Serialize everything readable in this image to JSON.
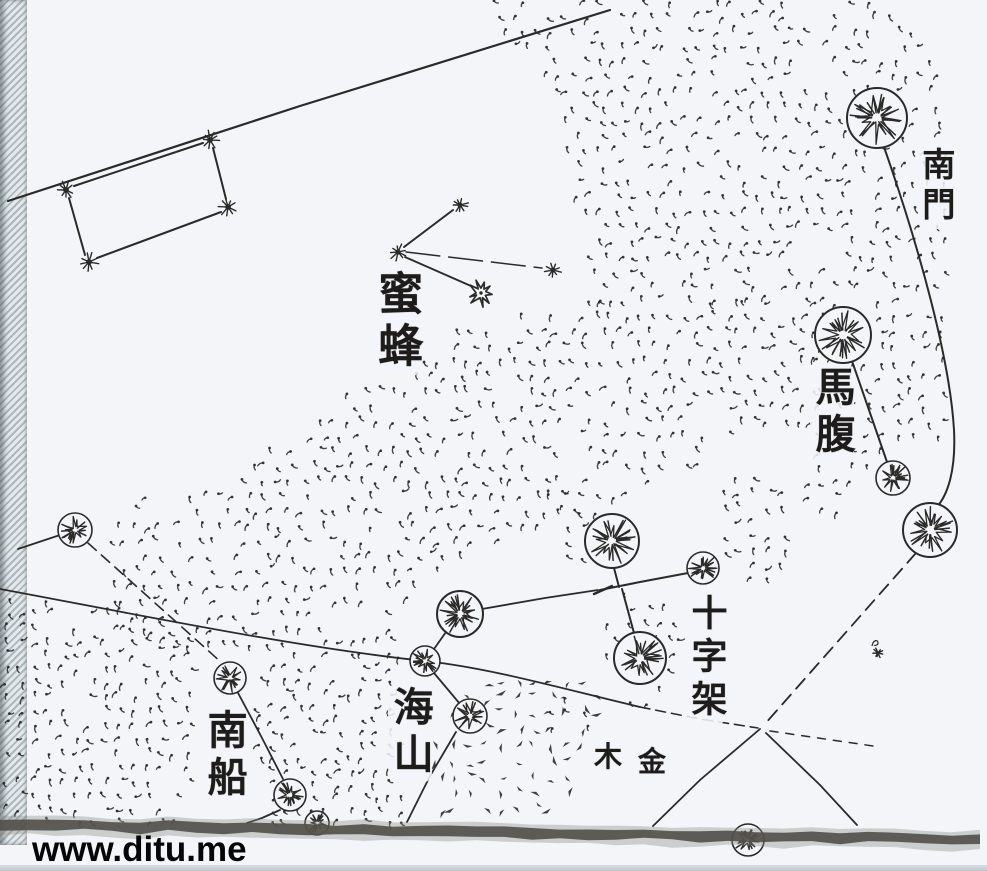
{
  "colors": {
    "paper": "#f3f5f9",
    "ink": "#2b2a28",
    "band": "#514f49",
    "band_halo": "#8f8d85",
    "border_strip": "#aab4b9",
    "watermark": "#060606"
  },
  "watermark": {
    "text": "www.ditu.me"
  },
  "labels": [
    {
      "id": "nanmen",
      "text": "南門",
      "x": 936,
      "y": 145,
      "size": 33,
      "orientation": "vertical"
    },
    {
      "id": "mifeng",
      "text": "蜜蜂",
      "x": 396,
      "y": 268,
      "size": 45,
      "orientation": "vertical"
    },
    {
      "id": "mafu",
      "text": "馬腹",
      "x": 832,
      "y": 364,
      "size": 40,
      "orientation": "vertical"
    },
    {
      "id": "shizijia",
      "text": "十字架",
      "x": 706,
      "y": 592,
      "size": 36,
      "orientation": "vertical"
    },
    {
      "id": "haishan",
      "text": "海山",
      "x": 410,
      "y": 684,
      "size": 40,
      "orientation": "vertical"
    },
    {
      "id": "nanchuan",
      "text": "南船",
      "x": 224,
      "y": 707,
      "size": 40,
      "orientation": "vertical"
    },
    {
      "id": "mu",
      "text": "木",
      "x": 608,
      "y": 741,
      "size": 28,
      "orientation": "horizontal"
    },
    {
      "id": "jin",
      "text": "金",
      "x": 652,
      "y": 746,
      "size": 28,
      "orientation": "horizontal"
    }
  ],
  "stars": {
    "circled": [
      {
        "x": 877,
        "y": 118,
        "r": 30
      },
      {
        "x": 843,
        "y": 335,
        "r": 28
      },
      {
        "x": 893,
        "y": 478,
        "r": 17
      },
      {
        "x": 930,
        "y": 530,
        "r": 27
      },
      {
        "x": 612,
        "y": 541,
        "r": 27
      },
      {
        "x": 703,
        "y": 568,
        "r": 16
      },
      {
        "x": 640,
        "y": 658,
        "r": 26
      },
      {
        "x": 460,
        "y": 614,
        "r": 23
      },
      {
        "x": 425,
        "y": 661,
        "r": 15
      },
      {
        "x": 470,
        "y": 716,
        "r": 17
      },
      {
        "x": 75,
        "y": 530,
        "r": 17
      },
      {
        "x": 230,
        "y": 678,
        "r": 16
      },
      {
        "x": 290,
        "y": 795,
        "r": 16
      },
      {
        "x": 748,
        "y": 840,
        "r": 16
      },
      {
        "x": 317,
        "y": 823,
        "r": 12
      }
    ],
    "small": [
      {
        "x": 66,
        "y": 190,
        "s": 9
      },
      {
        "x": 210,
        "y": 140,
        "s": 9
      },
      {
        "x": 228,
        "y": 207,
        "s": 9
      },
      {
        "x": 89,
        "y": 262,
        "s": 9
      },
      {
        "x": 398,
        "y": 252,
        "s": 8
      },
      {
        "x": 460,
        "y": 205,
        "s": 8
      },
      {
        "x": 553,
        "y": 270,
        "s": 8
      },
      {
        "x": 878,
        "y": 653,
        "s": 5
      }
    ],
    "burst": {
      "x": 481,
      "y": 293,
      "r": 13
    }
  },
  "lines": [
    {
      "id": "boundary-nw",
      "pts": [
        [
          8,
          201
        ],
        [
          300,
          106
        ],
        [
          610,
          10
        ]
      ],
      "w": 2.2
    },
    {
      "id": "quad-top",
      "pts": [
        [
          74,
          186
        ],
        [
          203,
          143
        ]
      ],
      "w": 2
    },
    {
      "id": "quad-right",
      "pts": [
        [
          213,
          148
        ],
        [
          226,
          199
        ]
      ],
      "w": 2
    },
    {
      "id": "quad-bottom",
      "pts": [
        [
          221,
          212
        ],
        [
          97,
          258
        ]
      ],
      "w": 2
    },
    {
      "id": "quad-left",
      "pts": [
        [
          85,
          255
        ],
        [
          69,
          198
        ]
      ],
      "w": 2
    },
    {
      "id": "bee-a",
      "pts": [
        [
          404,
          247
        ],
        [
          453,
          210
        ]
      ],
      "w": 2
    },
    {
      "id": "bee-b",
      "pts": [
        [
          405,
          257
        ],
        [
          471,
          286
        ]
      ],
      "w": 1.8
    },
    {
      "id": "bee-c",
      "pts": [
        [
          406,
          252
        ],
        [
          542,
          268
        ]
      ],
      "w": 1.5,
      "dash": "34 9"
    },
    {
      "id": "nanmen-arc",
      "path": "M884,147 C920,250 950,360 954,430 C956,470 948,495 936,508",
      "w": 2
    },
    {
      "id": "mafu-link",
      "pts": [
        [
          852,
          361
        ],
        [
          887,
          462
        ]
      ],
      "w": 2
    },
    {
      "id": "ecliptic-dash",
      "pts": [
        [
          916,
          553
        ],
        [
          764,
          725
        ]
      ],
      "w": 1.8,
      "dash": "13 8"
    },
    {
      "id": "cross-left-arm",
      "pts": [
        [
          760,
          729
        ],
        [
          700,
          780
        ],
        [
          653,
          826
        ]
      ],
      "w": 1.8
    },
    {
      "id": "cross-right-arm",
      "pts": [
        [
          766,
          733
        ],
        [
          820,
          785
        ],
        [
          857,
          825
        ]
      ],
      "w": 1.8
    },
    {
      "id": "cross-dashes-right",
      "pts": [
        [
          770,
          731
        ],
        [
          880,
          747
        ]
      ],
      "w": 1.5,
      "dash": "8 8"
    },
    {
      "id": "equator",
      "path": "M0,589 C140,615 300,648 425,661 C490,668 560,688 640,707",
      "w": 1.8
    },
    {
      "id": "equator-dash",
      "pts": [
        [
          640,
          707
        ],
        [
          700,
          719
        ],
        [
          758,
          728
        ]
      ],
      "w": 1.6,
      "dash": "10 6"
    },
    {
      "id": "k-west",
      "pts": [
        [
          18,
          549
        ],
        [
          60,
          535
        ]
      ],
      "w": 1.8
    },
    {
      "id": "k-l-dash",
      "pts": [
        [
          88,
          543
        ],
        [
          222,
          663
        ]
      ],
      "w": 1.6,
      "dash": "11 7"
    },
    {
      "id": "l-m",
      "pts": [
        [
          237,
          691
        ],
        [
          262,
          738
        ],
        [
          283,
          779
        ]
      ],
      "w": 1.8
    },
    {
      "id": "m-tail",
      "pts": [
        [
          280,
          810
        ],
        [
          262,
          818
        ],
        [
          247,
          823
        ]
      ],
      "w": 1.8
    },
    {
      "id": "crux-top",
      "pts": [
        [
          614,
          568
        ],
        [
          619,
          587
        ]
      ],
      "w": 2
    },
    {
      "id": "crux-east",
      "pts": [
        [
          600,
          590
        ],
        [
          640,
          582
        ],
        [
          688,
          573
        ]
      ],
      "w": 2
    },
    {
      "id": "crux-south",
      "pts": [
        [
          622,
          589
        ],
        [
          634,
          633
        ]
      ],
      "w": 2
    },
    {
      "id": "crux-west",
      "pts": [
        [
          482,
          609
        ],
        [
          545,
          598
        ],
        [
          598,
          590
        ]
      ],
      "w": 1.8
    },
    {
      "id": "haishan-a",
      "pts": [
        [
          446,
          632
        ],
        [
          434,
          649
        ]
      ],
      "w": 1.8
    },
    {
      "id": "haishan-b",
      "pts": [
        [
          434,
          673
        ],
        [
          460,
          704
        ]
      ],
      "w": 1.8
    },
    {
      "id": "haishan-tail",
      "pts": [
        [
          456,
          732
        ],
        [
          430,
          776
        ],
        [
          407,
          822
        ]
      ],
      "w": 1.8
    },
    {
      "id": "junction-scratch",
      "pts": [
        [
          594,
          594
        ],
        [
          612,
          586
        ]
      ],
      "w": 2.4
    }
  ]
}
